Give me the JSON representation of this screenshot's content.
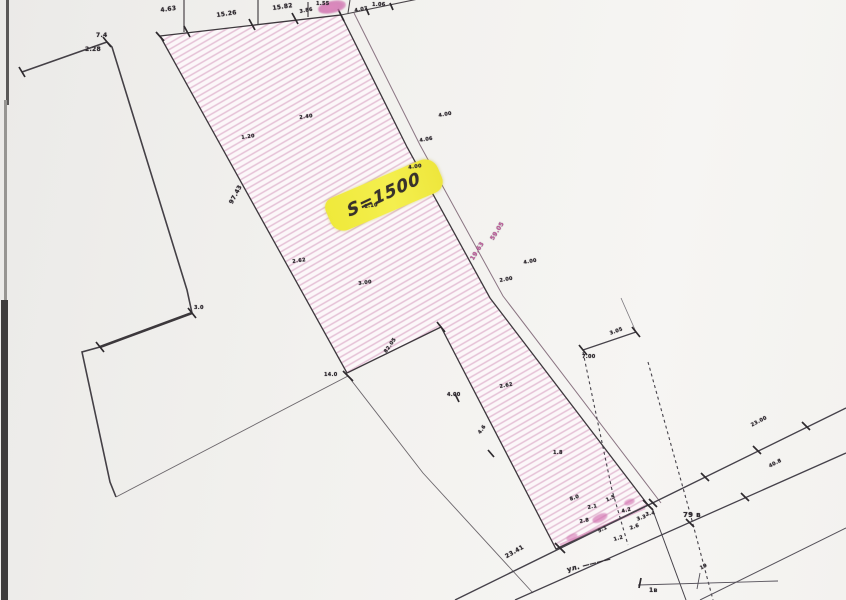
{
  "colors": {
    "hatch_pink": "#e5c1d6",
    "parcel_fill": "#fcf7f9",
    "boundary_ink": "#3d383d",
    "accent_magenta": "#c55ea0",
    "highlight_yellow": "#f0e93f",
    "label_ink": "#2f2b30",
    "scan_border": "#3e3c3c"
  },
  "parcel": {
    "area_label": "S=1500"
  },
  "street": {
    "prefix_label": "ул. ————"
  },
  "labels": [
    {
      "text": "4.63",
      "x": 160,
      "y": 7,
      "rot": -8,
      "size": 6
    },
    {
      "text": "15.26",
      "x": 216,
      "y": 12,
      "rot": -8,
      "size": 6
    },
    {
      "text": "15.82",
      "x": 272,
      "y": 5,
      "rot": -8,
      "size": 6
    },
    {
      "text": "3.86",
      "x": 299,
      "y": 9,
      "rot": -10,
      "size": 5
    },
    {
      "text": "1.55",
      "x": 316,
      "y": 1,
      "rot": 0,
      "size": 5
    },
    {
      "text": "4.07",
      "x": 354,
      "y": 8,
      "rot": -10,
      "size": 5
    },
    {
      "text": "1.06",
      "x": 372,
      "y": 2,
      "rot": 0,
      "size": 5
    },
    {
      "text": "7.4",
      "x": 96,
      "y": 32,
      "rot": 0,
      "size": 6
    },
    {
      "text": "2.28",
      "x": 85,
      "y": 46,
      "rot": 0,
      "size": 6
    },
    {
      "text": "97.43",
      "x": 228,
      "y": 202,
      "rot": -62,
      "size": 6
    },
    {
      "text": "4.00",
      "x": 438,
      "y": 113,
      "rot": -10,
      "size": 5
    },
    {
      "text": "4.06",
      "x": 419,
      "y": 138,
      "rot": -10,
      "size": 5
    },
    {
      "text": "59.05",
      "x": 489,
      "y": 238,
      "rot": -58,
      "size": 6,
      "color": "#c55ea0"
    },
    {
      "text": "19.63",
      "x": 469,
      "y": 258,
      "rot": -58,
      "size": 6,
      "color": "#c55ea0"
    },
    {
      "text": "4.00",
      "x": 523,
      "y": 260,
      "rot": -10,
      "size": 5
    },
    {
      "text": "2.00",
      "x": 499,
      "y": 278,
      "rot": -10,
      "size": 5
    },
    {
      "text": "1.20",
      "x": 241,
      "y": 135,
      "rot": -8,
      "size": 5
    },
    {
      "text": "2.40",
      "x": 299,
      "y": 115,
      "rot": -8,
      "size": 5
    },
    {
      "text": "1.10",
      "x": 364,
      "y": 204,
      "rot": -8,
      "size": 5
    },
    {
      "text": "4.00",
      "x": 408,
      "y": 165,
      "rot": -8,
      "size": 5
    },
    {
      "text": "2.62",
      "x": 292,
      "y": 259,
      "rot": -8,
      "size": 5
    },
    {
      "text": "3.00",
      "x": 358,
      "y": 281,
      "rot": -8,
      "size": 5
    },
    {
      "text": "14.0",
      "x": 324,
      "y": 372,
      "rot": 0,
      "size": 5
    },
    {
      "text": "82.05",
      "x": 383,
      "y": 351,
      "rot": -55,
      "size": 5
    },
    {
      "text": "3.0",
      "x": 194,
      "y": 305,
      "rot": 0,
      "size": 5
    },
    {
      "text": "4.00",
      "x": 447,
      "y": 392,
      "rot": 0,
      "size": 5
    },
    {
      "text": "2.62",
      "x": 499,
      "y": 384,
      "rot": -10,
      "size": 5
    },
    {
      "text": "4.6",
      "x": 477,
      "y": 432,
      "rot": -55,
      "size": 5
    },
    {
      "text": "1.8",
      "x": 553,
      "y": 450,
      "rot": 0,
      "size": 5
    },
    {
      "text": "7.00",
      "x": 582,
      "y": 354,
      "rot": 0,
      "size": 5
    },
    {
      "text": "3.05",
      "x": 609,
      "y": 331,
      "rot": -20,
      "size": 5
    },
    {
      "text": "79 в",
      "x": 683,
      "y": 511,
      "rot": 0,
      "size": 7
    },
    {
      "text": "23.00",
      "x": 750,
      "y": 423,
      "rot": -27,
      "size": 5
    },
    {
      "text": "40.8",
      "x": 768,
      "y": 464,
      "rot": -27,
      "size": 5
    },
    {
      "text": "23.41",
      "x": 504,
      "y": 554,
      "rot": -30,
      "size": 6
    },
    {
      "text": "ул. ————",
      "x": 566,
      "y": 566,
      "rot": -14,
      "size": 7
    },
    {
      "text": "1в",
      "x": 649,
      "y": 587,
      "rot": 0,
      "size": 6
    },
    {
      "text": "19",
      "x": 699,
      "y": 566,
      "rot": -27,
      "size": 5
    },
    {
      "text": "8.0",
      "x": 569,
      "y": 497,
      "rot": -20,
      "size": 5
    },
    {
      "text": "2.1",
      "x": 587,
      "y": 505,
      "rot": -10,
      "size": 5
    },
    {
      "text": "1.5",
      "x": 605,
      "y": 498,
      "rot": -25,
      "size": 5
    },
    {
      "text": "4.2",
      "x": 621,
      "y": 509,
      "rot": -15,
      "size": 5
    },
    {
      "text": "3.3",
      "x": 636,
      "y": 517,
      "rot": -20,
      "size": 5
    },
    {
      "text": "2.8",
      "x": 579,
      "y": 519,
      "rot": -10,
      "size": 5
    },
    {
      "text": "5.1",
      "x": 597,
      "y": 529,
      "rot": -25,
      "size": 5
    },
    {
      "text": "1.2",
      "x": 613,
      "y": 537,
      "rot": -15,
      "size": 5
    },
    {
      "text": "2.6",
      "x": 629,
      "y": 526,
      "rot": -20,
      "size": 5
    },
    {
      "text": "3.4",
      "x": 645,
      "y": 512,
      "rot": -10,
      "size": 5
    }
  ]
}
